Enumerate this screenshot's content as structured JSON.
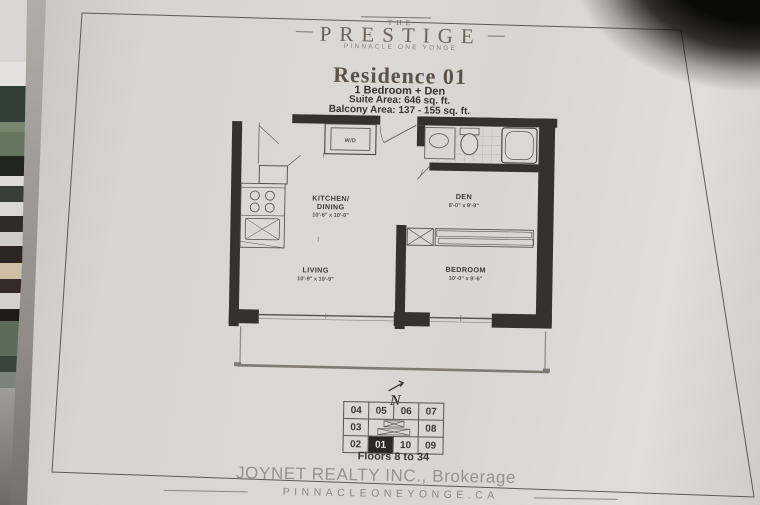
{
  "logo": {
    "the": "THE",
    "name": "PRESTIGE",
    "subtitle": "PINNACLE ONE YONGE"
  },
  "header": {
    "residence_title": "Residence 01",
    "unit_type": "1 Bedroom + Den",
    "suite_area": "Suite Area: 646 sq. ft.",
    "balcony_area": "Balcony Area: 137 - 155 sq. ft."
  },
  "floorplan": {
    "rooms": [
      {
        "line1": "KITCHEN/",
        "line2": "DINING",
        "dims": "10'-6\" x 10'-0\""
      },
      {
        "line1": "DEN",
        "dims": "8'-0\" x 9'-9\""
      },
      {
        "line1": "LIVING",
        "dims": "10'-9\" x 10'-9\""
      },
      {
        "line1": "BEDROOM",
        "dims": "10'-0\" x 9'-6\""
      }
    ],
    "laundry_label": "W/D",
    "north_label": "N"
  },
  "keyplan": {
    "units_row1": [
      "04",
      "05",
      "06",
      "07"
    ],
    "unit_03": "03",
    "unit_08": "08",
    "units_row3": [
      "02",
      "01",
      "10",
      "09"
    ],
    "highlighted_unit": "01",
    "floors_label": "Floors 8 to 34"
  },
  "footer": {
    "brokerage": "JOYNET REALTY INC., Brokerage",
    "website": "PINNACLEONEYONGE.CA"
  },
  "colors": {
    "paper": "#d8d5d2",
    "wall_ink": "#35312c",
    "title_brown": "#5b5349",
    "footer_gray": "#98928b"
  }
}
